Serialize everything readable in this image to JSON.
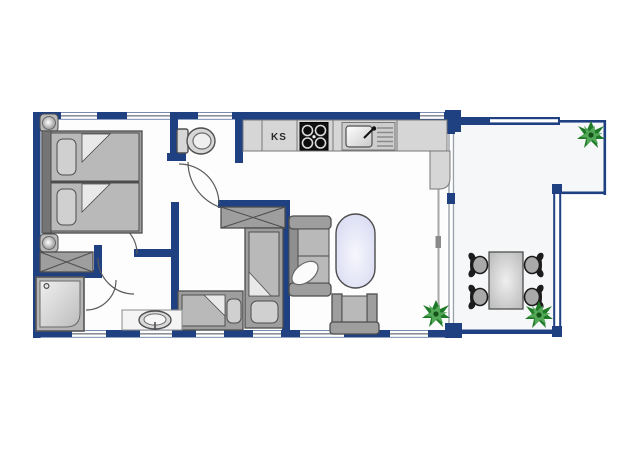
{
  "kitchen": {
    "fridge_label": "KS"
  },
  "palette": {
    "wall": "#1f4182",
    "winline": "#8a8f96",
    "floor": "#fdfdfd",
    "terracefloor": "#f5f7f9",
    "counter": "#d6d6d6",
    "counterBorder": "#787878",
    "furn": "#9e9e9e",
    "furnLight": "#b9b9b9",
    "pillow": "#d0d0d0",
    "frameDark": "#4d4d4d",
    "glass": "#9aa0a8",
    "stove": "#121212",
    "tableOvalEdge": "#dcdef4",
    "tableOvalCenter": "#f7f7fd",
    "plantDark": "#1f7a28",
    "plantLight": "#53a858"
  }
}
